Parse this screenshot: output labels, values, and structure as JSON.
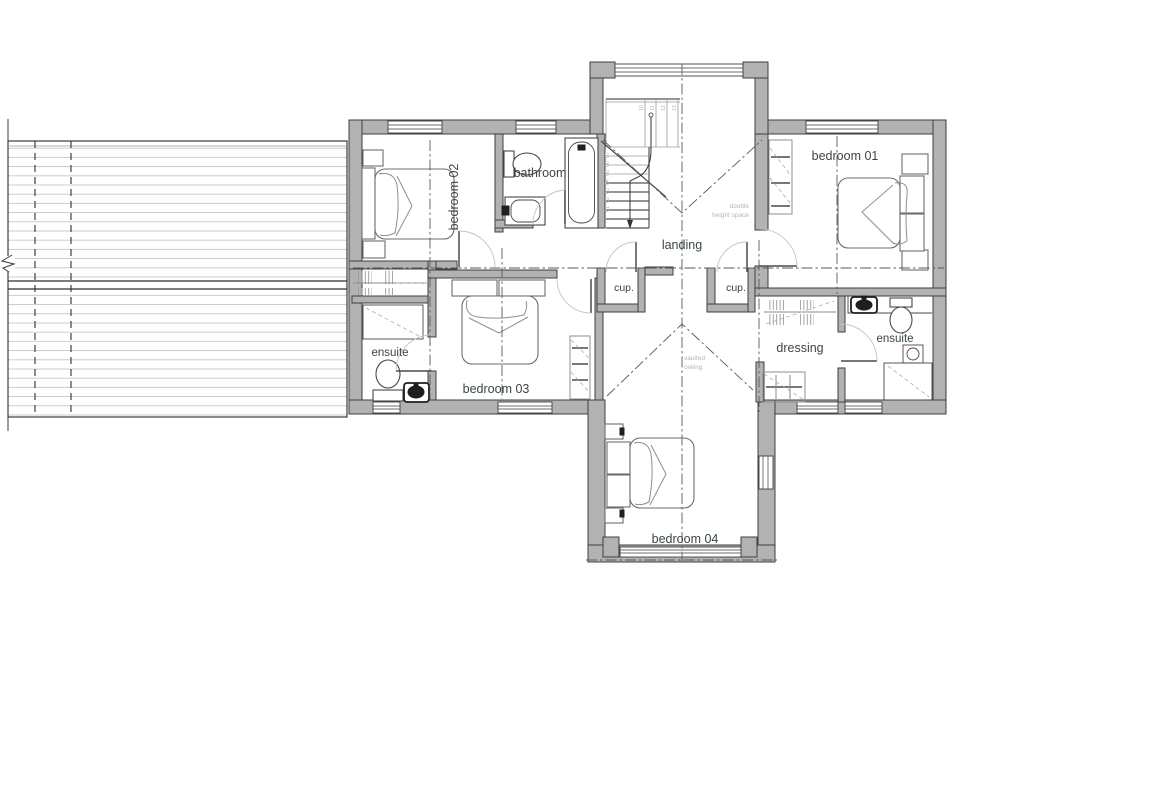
{
  "plan": {
    "rooms": {
      "bedroom01": {
        "label": "bedroom 01"
      },
      "bedroom02": {
        "label": "bedroom 02"
      },
      "bedroom03": {
        "label": "bedroom 03"
      },
      "bedroom04": {
        "label": "bedroom 04"
      },
      "bathroom": {
        "label": "bathroom"
      },
      "landing": {
        "label": "landing"
      },
      "dressing": {
        "label": "dressing"
      },
      "ensuite_left": {
        "label": "ensuite"
      },
      "ensuite_right": {
        "label": "ensuite"
      },
      "cupboard_left": {
        "label": "cup."
      },
      "cupboard_right": {
        "label": "cup."
      }
    },
    "annotations": {
      "double_height": [
        "double",
        "height space"
      ],
      "vaulted": [
        "vaulted",
        "ceiling"
      ]
    },
    "stairs": {
      "upper_treads": [
        "10",
        "11",
        "12",
        "13"
      ],
      "lower_treads": [
        "07",
        "06",
        "05",
        "04",
        "03",
        "02",
        "01"
      ]
    },
    "fixtures": [
      "double-bed",
      "bath",
      "toilet",
      "wash-basin",
      "shower",
      "wardrobe",
      "cupboard",
      "staircase",
      "roof-below"
    ],
    "colors": {
      "wall_fill": "#b2b2b2",
      "wall_outline": "#3f3f3f",
      "label_text": "#3a463d",
      "annotation_text": "#b5b5b5",
      "furniture_line": "#8f8f8f",
      "fixture_line": "#474747",
      "centerline": "#5a5a5a",
      "roof_line": "#c6c6c6",
      "door_arc": "#c4c4c4",
      "background": "#ffffff"
    }
  }
}
